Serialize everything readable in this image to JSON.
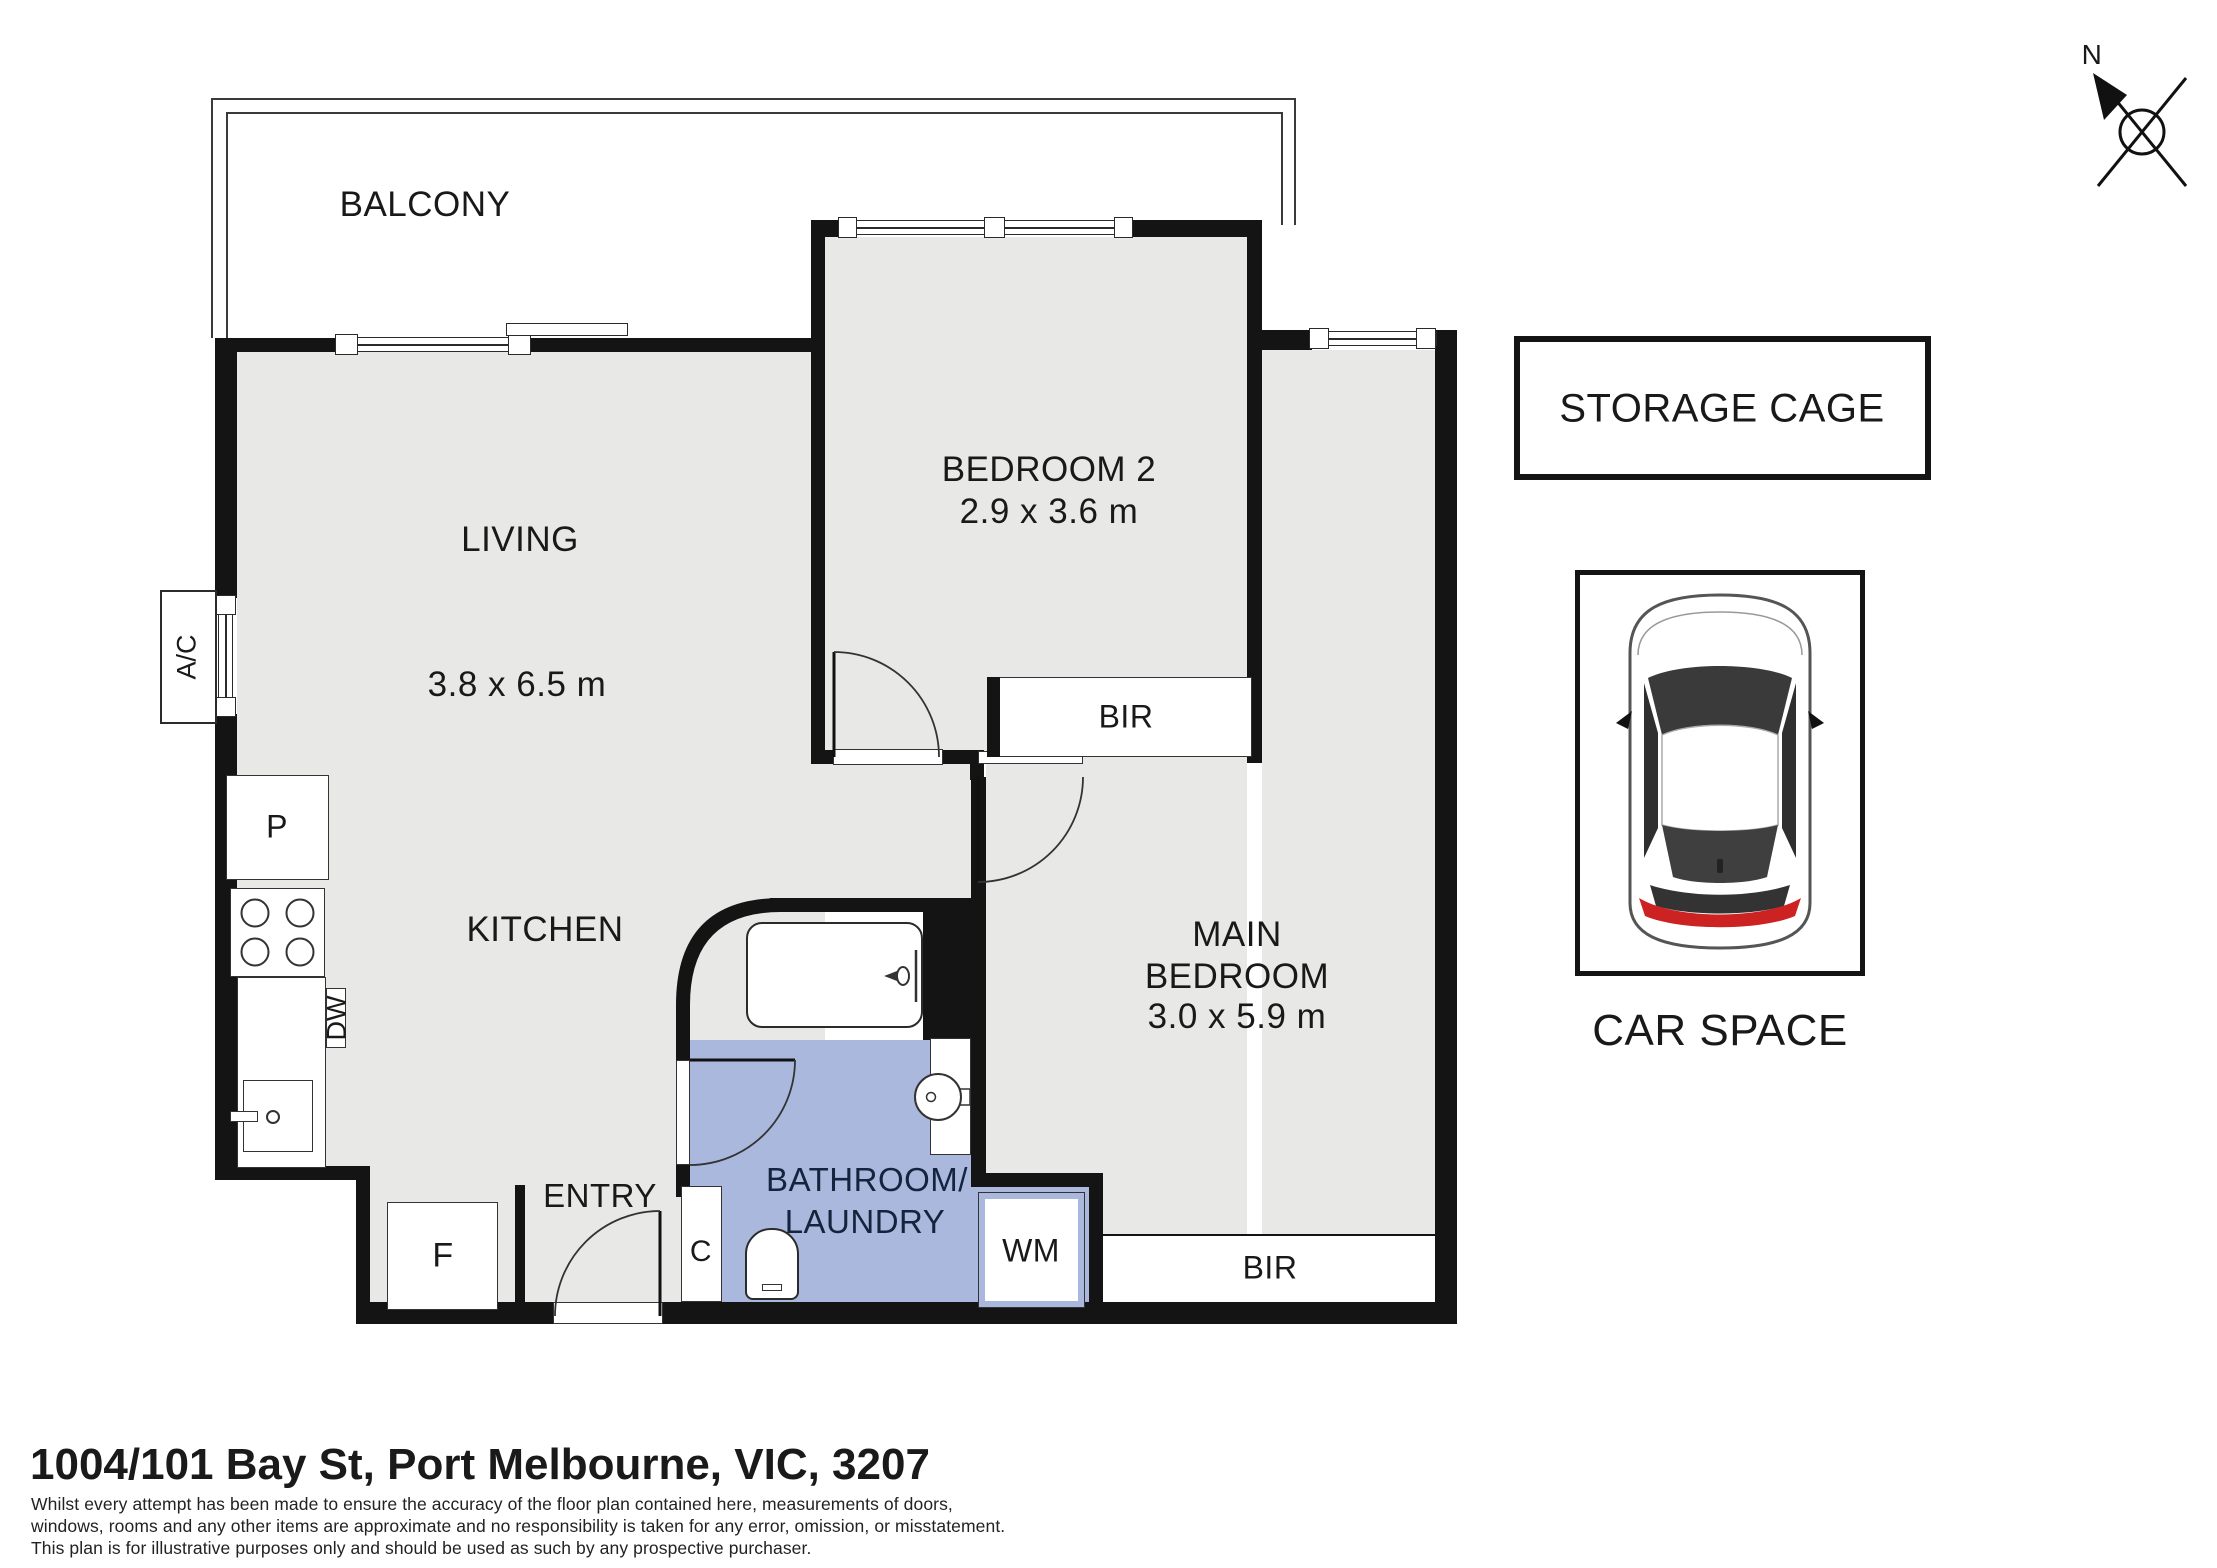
{
  "title": {
    "address": "1004/101 Bay St, Port Melbourne, VIC, 3207"
  },
  "disclaimer": {
    "line1": "Whilst every attempt has been made to ensure the accuracy of the floor plan contained here, measurements of doors,",
    "line2": "windows, rooms and any other items are approximate and no responsibility is taken for any error, omission, or misstatement.",
    "line3": "This plan is for illustrative purposes only and should be used as such by any prospective purchaser."
  },
  "compass": {
    "north_label": "N"
  },
  "rooms": {
    "balcony": {
      "label": "BALCONY"
    },
    "living": {
      "label": "LIVING",
      "dimensions": "3.8 x 6.5 m"
    },
    "kitchen": {
      "label": "KITCHEN"
    },
    "bedroom2": {
      "label": "BEDROOM 2",
      "dimensions": "2.9 x 3.6 m",
      "robe_label": "BIR"
    },
    "main_bedroom": {
      "label_line1": "MAIN",
      "label_line2": "BEDROOM",
      "dimensions": "3.0 x 5.9 m",
      "robe_label": "BIR"
    },
    "bathroom_laundry": {
      "label_line1": "BATHROOM/",
      "label_line2": "LAUNDRY"
    },
    "entry": {
      "label": "ENTRY"
    }
  },
  "fixtures": {
    "pantry": "P",
    "fridge": "F",
    "cupboard": "C",
    "washing_machine": "WM",
    "dishwasher": "DW",
    "air_conditioner": "A/C"
  },
  "outbuildings": {
    "storage_cage": "STORAGE CAGE",
    "car_space": "CAR SPACE"
  },
  "colors": {
    "wall": "#141414",
    "floor": "#e8e8e6",
    "wet_area": "#a9b8dc",
    "wet_text": "#16233f",
    "tail_light": "#cc2222"
  }
}
